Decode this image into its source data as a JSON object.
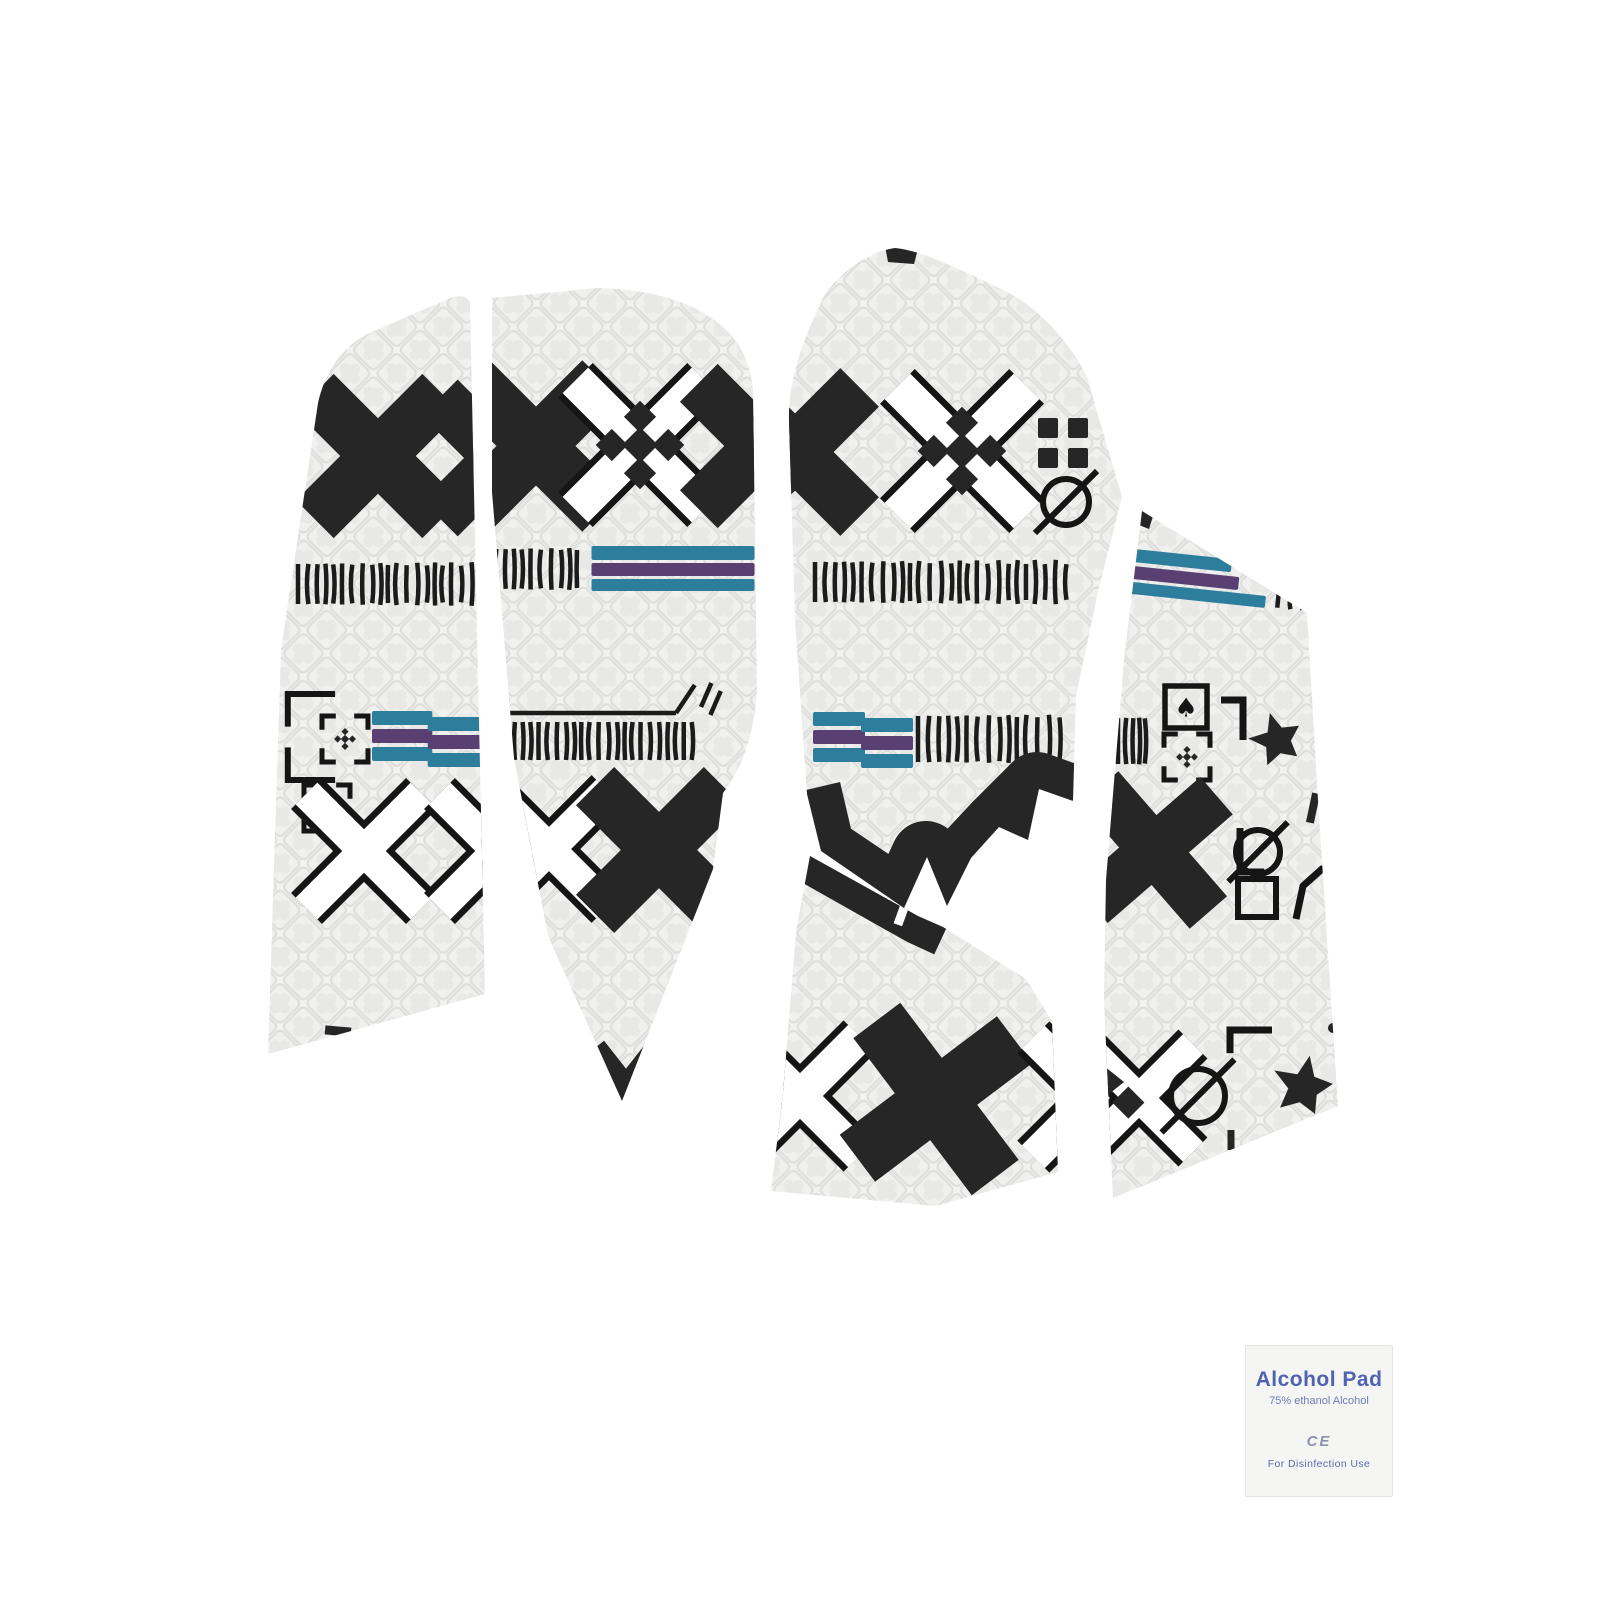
{
  "canvas": {
    "w": 1600,
    "h": 1600,
    "bg": "#ffffff"
  },
  "colors": {
    "black": "#262626",
    "outline": "#151515",
    "dash": "#1b1b1b",
    "teal": "#2d7d9c",
    "purple": "#5a3f72",
    "white": "#ffffff",
    "tex_bg": "#f2f2f1",
    "tex_cell": "#f0f0ee",
    "tex_line": "#dededd",
    "tex_blob": "#e8e8e6"
  },
  "product": {
    "description": "mouse grip tape sticker set, white tribal pattern with black X motifs and teal-purple stripes"
  },
  "pieces": [
    {
      "name": "grip-piece-left-side",
      "path": "M 318 403 C 327 362 352 340 374 331 L 448 299 C 461 294 469 296 470 304 L 475 540 L 485 994 L 268 1054 L 281 650 Z",
      "motifs": [
        {
          "type": "x-filled",
          "x": 378,
          "y": 456,
          "s": 178
        },
        {
          "type": "x-filled",
          "x": 500,
          "y": 458,
          "s": 170
        },
        {
          "type": "dash-row",
          "x": 389,
          "y": 584,
          "w": 182,
          "n": 21,
          "h": 40
        },
        {
          "type": "big-bracket",
          "x": 305,
          "y": 737,
          "s": 86
        },
        {
          "type": "bracket-plus",
          "x": 345,
          "y": 739,
          "s": 46
        },
        {
          "type": "stripe-block",
          "x": 430,
          "y": 737,
          "w": 116
        },
        {
          "type": "bracket-plus",
          "x": 327,
          "y": 808,
          "s": 46
        },
        {
          "type": "x-outline",
          "x": 364,
          "y": 851,
          "s": 162
        },
        {
          "type": "x-outline",
          "x": 497,
          "y": 851,
          "s": 162
        },
        {
          "type": "tick",
          "x": 338,
          "y": 1031,
          "len": 26,
          "rot": 95,
          "w": 9
        }
      ]
    },
    {
      "name": "grip-piece-palm",
      "path": "M 492 298 L 598 288 C 652 289 700 303 727 331 C 745 349 751 369 753 391 L 757 690 C 753 746 738 773 723 793 L 713 869 L 622 1101 L 548 936 L 514 758 L 492 492 Z",
      "motifs": [
        {
          "type": "x-filled",
          "x": 536,
          "y": 446,
          "s": 186
        },
        {
          "type": "x-outline-diamonds",
          "x": 640,
          "y": 445,
          "s": 182
        },
        {
          "type": "x-filled",
          "x": 762,
          "y": 446,
          "s": 178
        },
        {
          "type": "dash-row",
          "x": 532,
          "y": 569,
          "w": 92,
          "n": 11,
          "h": 40
        },
        {
          "type": "stripe-lines",
          "x": 673,
          "y": 568,
          "w": 163
        },
        {
          "type": "comb",
          "x": 597,
          "y": 713,
          "w": 208
        },
        {
          "type": "x-outline",
          "x": 549,
          "y": 849,
          "s": 164
        },
        {
          "type": "x-filled",
          "x": 659,
          "y": 850,
          "s": 180
        },
        {
          "type": "v-tip",
          "x": 626,
          "y": 1072,
          "s": 62
        }
      ]
    },
    {
      "name": "grip-piece-top-middle",
      "path": "M 824 296 C 840 272 868 252 895 248 C 920 250 962 270 1001 289 C 1031 303 1062 331 1086 374 L 1122 497 L 1098 592 L 1076 696 L 1073 801 L 1039 789 L 1028 840 L 999 827 L 971 858 L 947 906 L 927 857 L 904 908 L 821 851 L 807 794 L 795 620 L 789 420 C 788 385 800 345 824 296 Z",
      "motifs": [
        {
          "type": "patch",
          "pts": "885,246 918,249 914,264 888,262"
        },
        {
          "type": "x-filled",
          "x": 795,
          "y": 452,
          "s": 182
        },
        {
          "type": "x-outline-diamonds",
          "x": 962,
          "y": 451,
          "s": 182
        },
        {
          "type": "grid2x2",
          "x": 1063,
          "y": 443,
          "s": 50
        },
        {
          "type": "slashed-circle",
          "x": 1066,
          "y": 502,
          "r": 23
        },
        {
          "type": "dash-row",
          "x": 940,
          "y": 582,
          "w": 250,
          "n": 27,
          "h": 40
        },
        {
          "type": "stripe-block",
          "x": 863,
          "y": 738,
          "w": 100
        },
        {
          "type": "dash-row",
          "x": 988,
          "y": 739,
          "w": 140,
          "n": 15,
          "h": 46
        },
        {
          "type": "band",
          "path": "M 806 790 L 820 850 L 903 906 L 926 856 L 946 903 L 970 856 L 998 826 L 1037 787 L 1073 800",
          "w": 70
        }
      ]
    },
    {
      "name": "grip-piece-bottom-middle",
      "path": "M 810 856 L 918 916 L 943 927 L 1026 979 L 1052 1021 L 1058 1172 L 936 1206 L 771 1191 L 783 1094 L 796 931 Z",
      "motifs": [
        {
          "type": "band",
          "path": "M 803 851 L 920 917 L 946 929",
          "w": 56
        },
        {
          "type": "tick",
          "x": 905,
          "y": 905,
          "len": 42,
          "rot": 20,
          "w": 9,
          "color": "white"
        },
        {
          "type": "x-outline",
          "x": 800,
          "y": 1096,
          "s": 168
        },
        {
          "type": "x-filled",
          "x": 936,
          "y": 1099,
          "s": 196,
          "rot": 8
        },
        {
          "type": "x-outline",
          "x": 1093,
          "y": 1097,
          "s": 168
        }
      ]
    },
    {
      "name": "grip-piece-right-side",
      "path": "M 1142 511 L 1307 613 L 1318 800 L 1338 1106 L 1113 1198 L 1104 1000 L 1106 880 L 1124 660 Z",
      "motifs": [
        {
          "type": "patch",
          "pts": "1136,508 1154,513 1149,529 1134,523"
        },
        {
          "type": "stripe-lines-slant",
          "x": 1200,
          "y": 578,
          "w": 150
        },
        {
          "type": "dash-row",
          "x": 1290,
          "y": 601,
          "w": 24,
          "n": 3,
          "h": 16,
          "rot": 6
        },
        {
          "type": "dash-row",
          "x": 1132,
          "y": 741,
          "w": 28,
          "n": 5,
          "h": 46
        },
        {
          "type": "spade-square",
          "x": 1186,
          "y": 707,
          "s": 42
        },
        {
          "type": "corner-bracket",
          "x": 1243,
          "y": 700,
          "s": 40,
          "rot": 90
        },
        {
          "type": "star",
          "x": 1277,
          "y": 740,
          "s": 56,
          "rot": -15
        },
        {
          "type": "bracket-plus",
          "x": 1187,
          "y": 757,
          "s": 46
        },
        {
          "type": "corner-bracket",
          "x": 1240,
          "y": 872,
          "s": 44,
          "rot": 270
        },
        {
          "type": "tick",
          "x": 1313,
          "y": 808,
          "len": 30,
          "rot": 12,
          "w": 8
        },
        {
          "type": "x-filled",
          "x": 1154,
          "y": 850,
          "s": 165,
          "rot": 4
        },
        {
          "type": "slashed-circle",
          "x": 1258,
          "y": 852,
          "r": 22
        },
        {
          "type": "square",
          "x": 1257,
          "y": 898,
          "s": 38
        },
        {
          "type": "polyline",
          "pts": "1296,919 1303,886 1322,869 1338,866",
          "w": 7
        },
        {
          "type": "x-outline-dot",
          "x": 1139,
          "y": 1098,
          "s": 152
        },
        {
          "type": "patch",
          "pts": "1104,1066 1124,1082 1104,1098"
        },
        {
          "type": "corner-bracket",
          "x": 1230,
          "y": 1030,
          "s": 42,
          "rot": 0
        },
        {
          "type": "slashed-circle",
          "x": 1198,
          "y": 1096,
          "r": 27
        },
        {
          "type": "tick",
          "x": 1231,
          "y": 1140,
          "len": 20,
          "rot": 0,
          "w": 7
        },
        {
          "type": "star",
          "x": 1303,
          "y": 1087,
          "s": 64,
          "rot": 12
        },
        {
          "type": "dot",
          "x": 1333,
          "y": 1028,
          "r": 5
        },
        {
          "type": "corner-bracket",
          "x": 1312,
          "y": 1165,
          "s": 36,
          "rot": 270
        }
      ]
    }
  ],
  "packet": {
    "title": "Alcohol Pad",
    "subtitle": "75% ethanol Alcohol",
    "ce_mark": "CE",
    "bottom_line": "For  Disinfection  Use",
    "bg": "#f5f5f3",
    "title_color": "#4f63b2",
    "subtitle_color": "#6f7cb8",
    "ce_color": "#8a92ad",
    "usage_color": "#5c6cb0"
  }
}
